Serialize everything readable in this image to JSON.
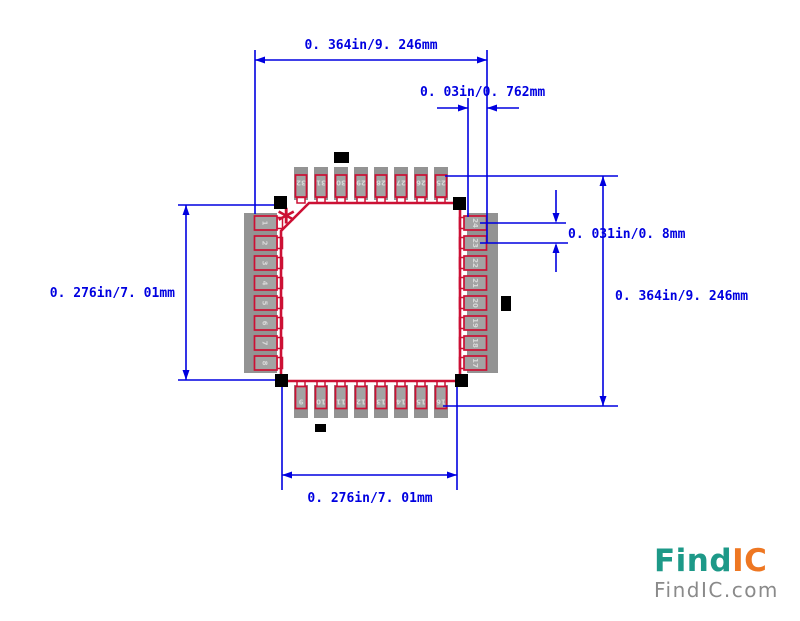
{
  "diagram": {
    "dim_top_width": "0. 364in/9. 246mm",
    "dim_lead_length": "0. 03in/0. 762mm",
    "dim_pitch": "0. 031in/0. 8mm",
    "dim_right_height": "0. 364in/9. 246mm",
    "dim_left_height": "0. 276in/7. 01mm",
    "dim_bottom_width": "0. 276in/7. 01mm"
  },
  "package": {
    "pin1_marker": "*",
    "pins_top_left_to_right": [
      "32",
      "31",
      "30",
      "29",
      "28",
      "27",
      "26",
      "25"
    ],
    "pins_left_top_to_bottom": [
      "1",
      "2",
      "3",
      "4",
      "5",
      "6",
      "7",
      "8"
    ],
    "pins_right_top_to_bottom": [
      "24",
      "23",
      "22",
      "21",
      "20",
      "19",
      "18",
      "17"
    ],
    "pins_bottom_left_to_right": [
      "9",
      "10",
      "11",
      "12",
      "13",
      "14",
      "15",
      "16"
    ]
  },
  "logo": {
    "brand_primary": "Find",
    "brand_secondary": "IC",
    "domain": "FindIC.com"
  },
  "colors": {
    "dimension_blue": "#0000e0",
    "outline_red": "#cc1034",
    "pad_gray": "#939393",
    "lead_gray": "#a3a3a3",
    "stub_white": "#ffffff",
    "marker_black": "#000000",
    "logo_teal": "#1d9988",
    "logo_orange": "#ee7722",
    "logo_gray": "#8a8a8a"
  }
}
